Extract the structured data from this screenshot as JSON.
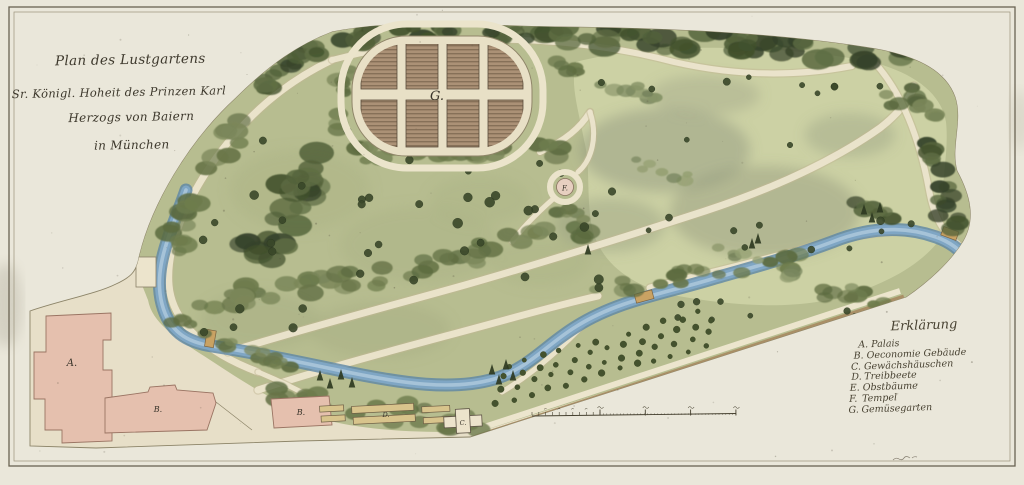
{
  "document": {
    "title_lines": [
      "Plan des Lustgartens",
      "Sr. Königl. Hoheit des Prinzen Karl",
      "Herzogs von Baiern",
      "in München"
    ]
  },
  "map_labels": {
    "palais": "A.",
    "oeconomie": "B.",
    "gewaechshaus": "C.",
    "treibbeete": "D.",
    "tempel": "F.",
    "gemuesegarten": "G."
  },
  "legend": {
    "heading": "Erklärung",
    "entries": [
      {
        "key": "A.",
        "label": "Palais"
      },
      {
        "key": "B.",
        "label": "Oeconomie Gebäude"
      },
      {
        "key": "C.",
        "label": "Gewächshäuschen"
      },
      {
        "key": "D.",
        "label": "Treibbeete"
      },
      {
        "key": "E.",
        "label": "Obstbäume"
      },
      {
        "key": "F.",
        "label": "Tempel"
      },
      {
        "key": "G.",
        "label": "Gemüsegarten"
      }
    ]
  },
  "colors": {
    "paper": "#eae7da",
    "ink": "#3e392e",
    "water": "#7fa6c4",
    "building": "#e5c0ae",
    "park_green": "#b7bd90"
  }
}
